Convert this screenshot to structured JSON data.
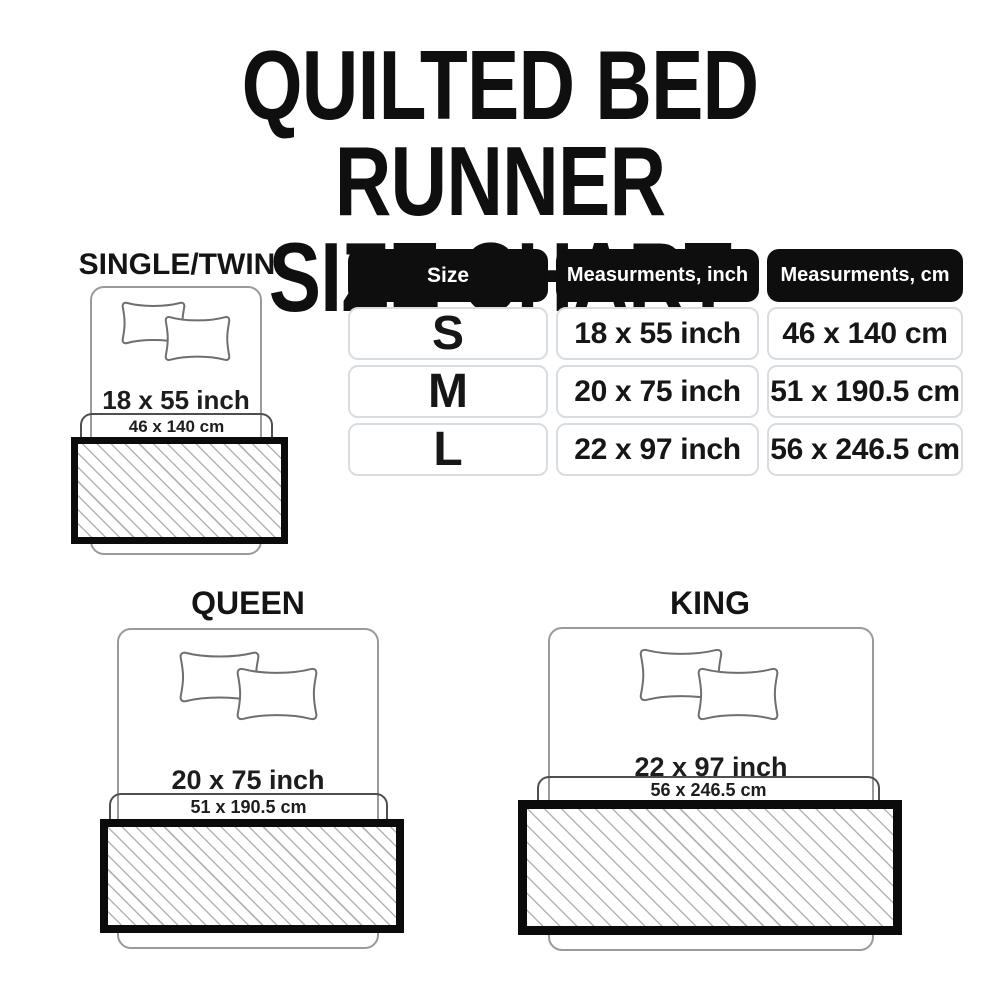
{
  "title": {
    "line1": "QUILTED BED RUNNER",
    "line2": "SIZE CHART"
  },
  "table": {
    "headers": [
      "Size",
      "Measurments, inch",
      "Measurments, cm"
    ],
    "rows": [
      {
        "size": "S",
        "inch": "18 x 55 inch",
        "cm": "46 x 140 cm"
      },
      {
        "size": "M",
        "inch": "20 x 75 inch",
        "cm": "51 x 190.5 cm"
      },
      {
        "size": "L",
        "inch": "22 x 97 inch",
        "cm": "56 x 246.5 cm"
      }
    ]
  },
  "diagrams": [
    {
      "label": "SINGLE/TWIN",
      "inch": "18 x 55 inch",
      "cm": "46 x 140 cm"
    },
    {
      "label": "QUEEN",
      "inch": "20 x 75 inch",
      "cm": "51 x 190.5 cm"
    },
    {
      "label": "KING",
      "inch": "22 x 97 inch",
      "cm": "56 x 246.5 cm"
    }
  ],
  "colors": {
    "background": "#ffffff",
    "text": "#111111",
    "table_header_bg": "#0e0e0e",
    "table_header_text": "#ffffff",
    "table_cell_border": "#d8dde2",
    "runner_border": "#0b0b0b",
    "runner_hatch": "#b4b4b4",
    "bed_outline": "#9a9a9a",
    "pillow_outline": "#6f6f6f",
    "bracket_outline": "#4f4f4f"
  }
}
